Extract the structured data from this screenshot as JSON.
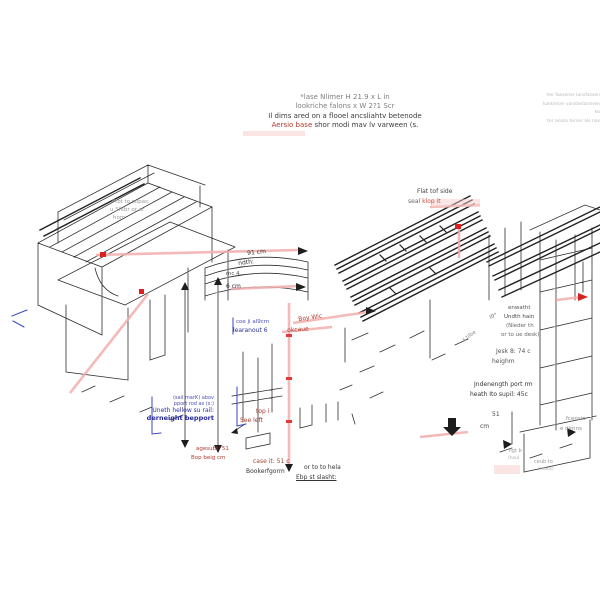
{
  "colors": {
    "annotation_red": "#b03a2e",
    "marker_red": "#dd1f1f",
    "pink_dimension": "#f2adad",
    "annotation_blue": "#2b2f9a",
    "line_art": "#2f2f2f",
    "faint_gray": "#b9b9b9"
  },
  "header": {
    "line1": "*lase Nlimer H 21.9 x L  in",
    "line2": "lookriche falons x W 2?1 Scr",
    "line3": "Il dims ared on a flooel ancsliahtv betenode",
    "line4_red": "Aersio base",
    "line4_rest": " shor modi mav lv varween (s."
  },
  "corner_note": {
    "line1": "her fassener lansfassen",
    "line2": "kanterser vansteilarreren ko",
    "line3": "ter anssa terser als nas"
  },
  "labels": {
    "prot1": "Prot to supas:",
    "prot2": "u Sfkbr or ar",
    "prot3": "hom",
    "dim_91": "91 cm",
    "dim_ndth": "ndth:",
    "dim_mc": "mc 4",
    "dim_6cm": "6 cm",
    "blue_note1": "coe ji al9cm",
    "blue_note2": "learanout 6",
    "red_boywic": "Boy Wic",
    "red_okcau": "okcaue",
    "flat1": "Flat tof side",
    "flat2_gray": "seal ",
    "flat2_red": "klop it",
    "right1": "enwatht",
    "right2": "Undth hain",
    "right3": "(Nieder th",
    "right4": "or to ue desk)",
    "deg": "(0°",
    "tilt": "s tilbe",
    "jesk1": "Jesk 8: 74 c",
    "jesk2": "heighm",
    "under1": "Jndenength port rm",
    "under2": "heath Ito supil: 45c",
    "dim51": "51",
    "dimcm": "cm",
    "cens1": "fcensio",
    "cens2": "e dimns",
    "bluebox1": "(sail marK) abov",
    "bluebox2": "pport rod as (s:)",
    "bluebox3": "Uneth hellow su rail:",
    "bluebox4": "derneight bepport",
    "topi": "top i",
    "seeleft": "See left",
    "age1": "agesubt: 51",
    "age2": "Bop beig cm",
    "case": "case it: 51 c",
    "booker": "Bookerfgorm",
    "orto": "or to to hela",
    "ebp": "Ebp st slasht:",
    "ligt1": "ligt b",
    "ligt2": "(hsu)",
    "ceub1": "ceub to",
    "ceub2": "(mack)"
  }
}
